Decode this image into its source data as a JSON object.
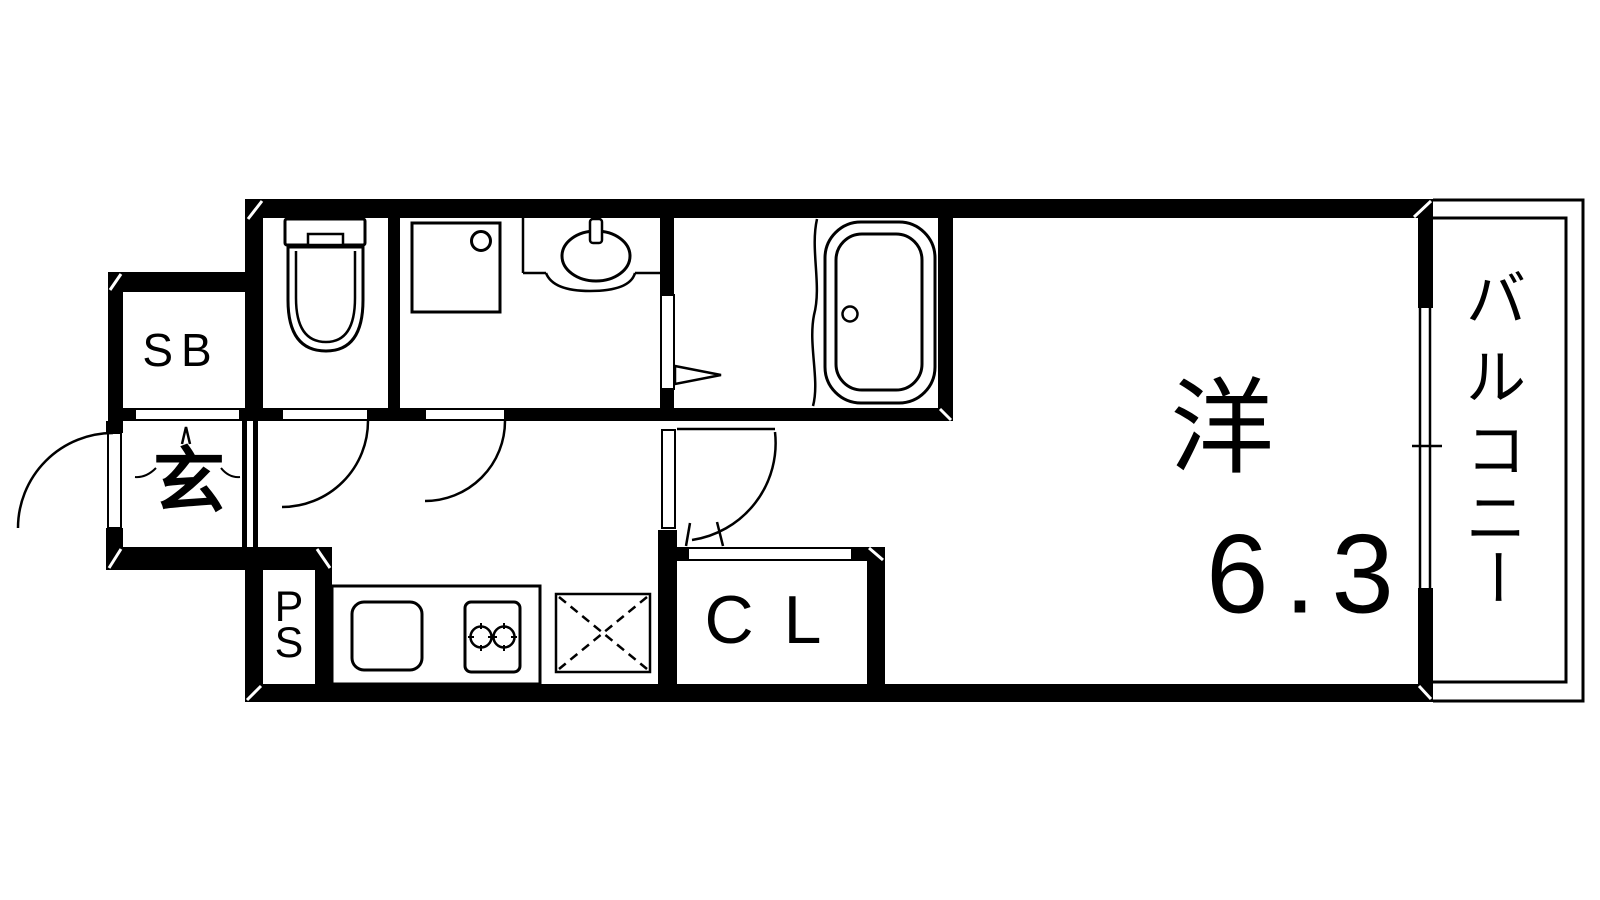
{
  "floor_plan": {
    "labels": {
      "shoe_box": "SB",
      "entrance": "玄",
      "pipe_space_p": "P",
      "pipe_space_s": "S",
      "closet": "CL",
      "western_room": "洋",
      "western_room_size": "6.3",
      "balcony": "バルコニー",
      "balcony_chars": [
        "バ",
        "ル",
        "コ",
        "ニ",
        "ー"
      ]
    },
    "colors": {
      "walls": "#000000",
      "background": "#ffffff",
      "lines": "#000000"
    }
  }
}
